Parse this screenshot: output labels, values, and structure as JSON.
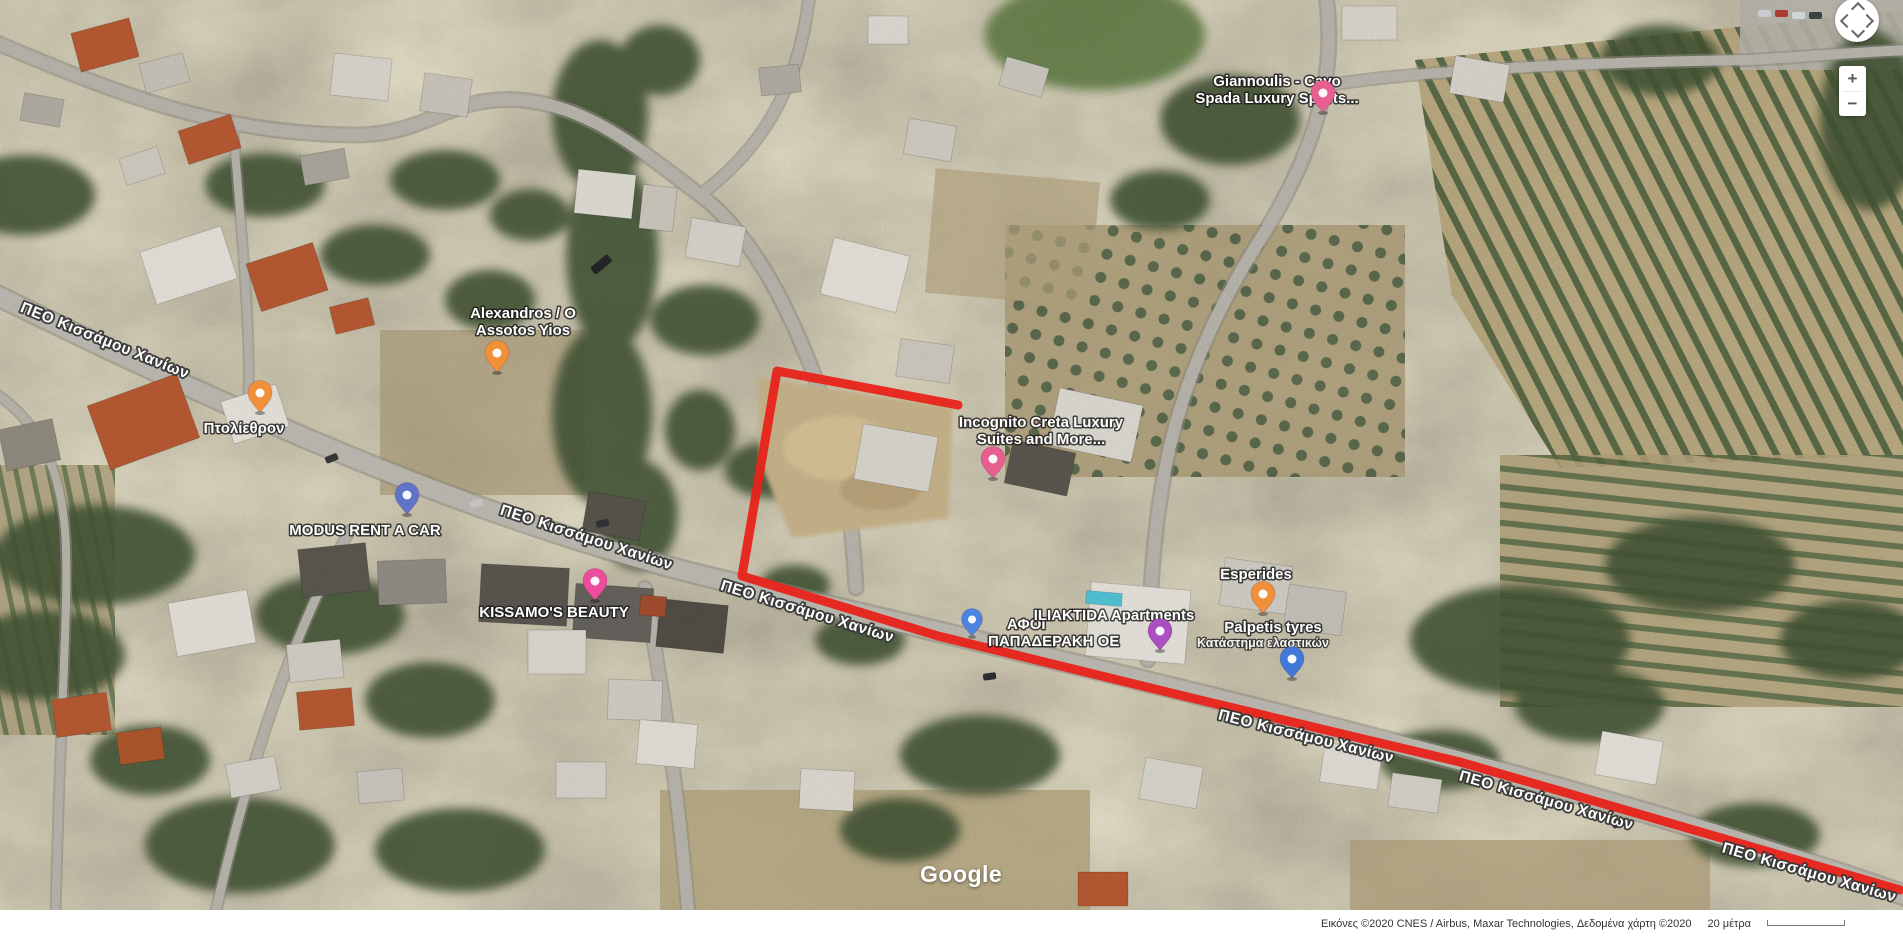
{
  "map": {
    "watermark": "Google",
    "road_label": "ΠΕΟ Κισσάμου Χανίων",
    "attribution_text": "Εικόνες ©2020 CNES / Airbus, Maxar Technologies, Δεδομένα χάρτη ©2020",
    "scale_label": "20 μέτρα",
    "controls": {
      "zoom_in_label": "+",
      "zoom_out_label": "−"
    }
  },
  "annotation": {
    "color": "#e8231a",
    "points": "958,405 777,371 742,576 938,636 1200,700 1460,762 1900,890"
  },
  "places": [
    {
      "name": "Giannoulis - Cavo Spada Luxury Sports",
      "lines": [
        "Giannoulis - Cavo",
        "Spada Luxury Sports..."
      ],
      "category": "lodging",
      "pin_color": "#e75f90"
    },
    {
      "name": "Alexandros / O Assotos Yios",
      "lines": [
        "Alexandros / O",
        "Assotos Yios"
      ],
      "category": "restaurant",
      "pin_color": "#f0913a"
    },
    {
      "name": "Πτολίεθρον",
      "lines": [
        "Πτολίεθρον"
      ],
      "category": "restaurant",
      "pin_color": "#f0913a"
    },
    {
      "name": "MODUS RENT A CAR",
      "lines": [
        "MODUS RENT A CAR"
      ],
      "category": "car-rental",
      "pin_color": "#5f74c9"
    },
    {
      "name": "KISSAMO'S BEAUTY",
      "lines": [
        "KISSAMO'S BEAUTY"
      ],
      "category": "beauty-shop",
      "pin_color": "#ec4d9d"
    },
    {
      "name": "Incognito Creta Luxury Suites and More...",
      "lines": [
        "Incognito Creta Luxury",
        "Suites and More..."
      ],
      "category": "lodging",
      "pin_color": "#e75f90"
    },
    {
      "name": "ΑΦΟΙ ΠΑΠΑΔΕΡΑΚΗ ΟΕ",
      "lines": [
        "ΑΦΟΙ",
        "ΠΑΠΑΔΕΡΑΚΗ ΟΕ"
      ],
      "category": "business",
      "pin_color": "#4a84e0"
    },
    {
      "name": "ILIAKTIDA Apartments",
      "lines": [
        "ILIAKTIDA Apartments"
      ],
      "category": "lodging",
      "pin_color": "#a94fc0"
    },
    {
      "name": "Esperides",
      "lines": [
        "Esperides"
      ],
      "category": "restaurant",
      "pin_color": "#f0913a"
    },
    {
      "name": "Palpetis tyres",
      "lines": [
        "Palpetis tyres",
        "Κατάστημα ελαστικών"
      ],
      "category": "tyre-shop",
      "pin_color": "#3f78d6"
    }
  ]
}
